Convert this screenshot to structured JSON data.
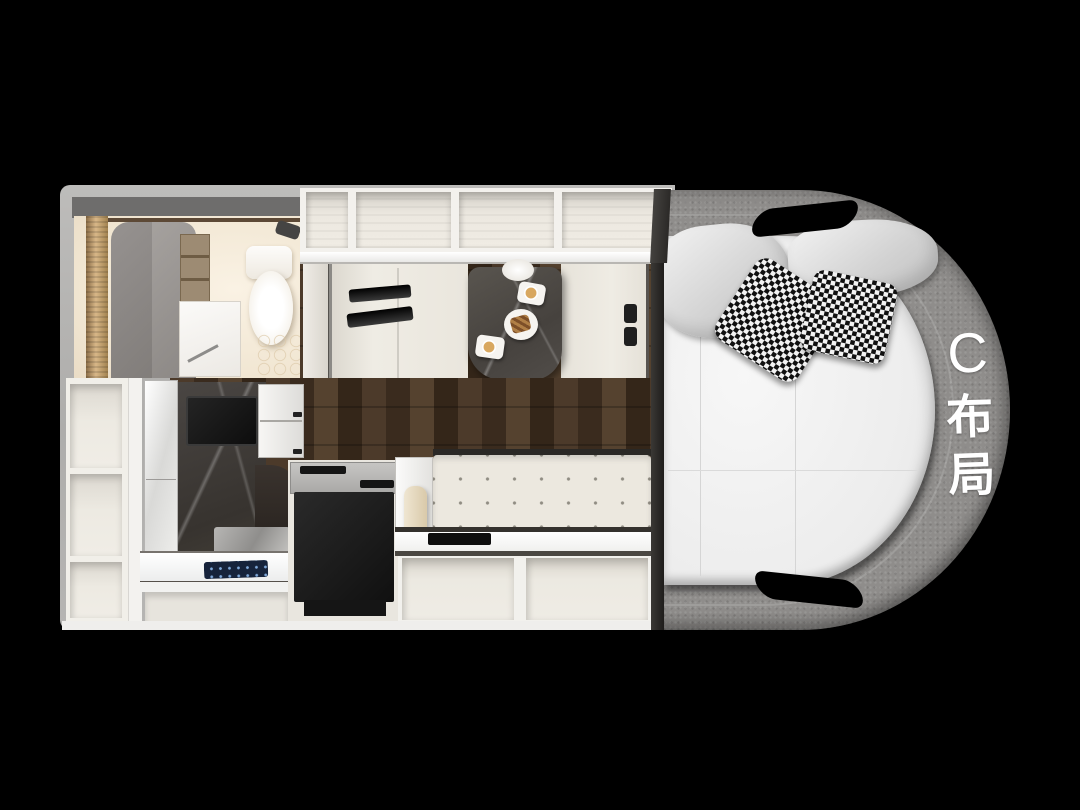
{
  "layout_label": {
    "full": "C布局",
    "chars": [
      "C",
      "布",
      "局"
    ]
  },
  "palette": {
    "background": "#000000",
    "shell_gray": "#b3b2b0",
    "fabric_band_gray": "#8f8d8b",
    "mattress_white": "#efefef",
    "cabinet_cream": "#eae7e0",
    "wood_floor_brown": "#3f2f22",
    "marble_dark": "#46423e",
    "appliance_black": "#151515",
    "bathroom_cream": "#f3e9d8",
    "label_text": "#ffffff"
  }
}
